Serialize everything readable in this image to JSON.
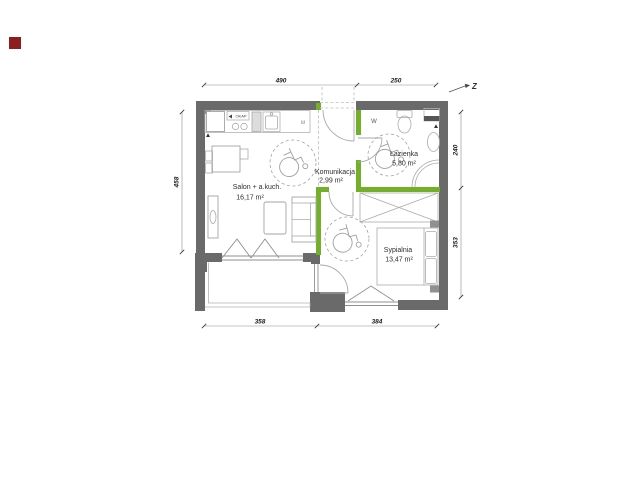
{
  "logo": {
    "color": "#8e1e1e"
  },
  "compass": {
    "label": "Z"
  },
  "rooms": [
    {
      "name": "Salon + a.kuch.",
      "area": "16,17 m²"
    },
    {
      "name": "Komunikacja",
      "area": "2,99 m²"
    },
    {
      "name": "Łazienka",
      "area": "5,80 m²"
    },
    {
      "name": "Sypialnia",
      "area": "13,47 m²"
    }
  ],
  "dimensions": {
    "top": [
      "490",
      "250"
    ],
    "bottom": [
      "358",
      "384"
    ],
    "left": [
      "458"
    ],
    "right": [
      "240",
      "353"
    ]
  },
  "annotations": {
    "hood": "OKAP",
    "washer_mark": "W",
    "counter_glyph": "ш"
  },
  "colors": {
    "wall": "#6a6a6a",
    "accent_green": "#72b02a",
    "logo_red": "#8e1e1e"
  }
}
